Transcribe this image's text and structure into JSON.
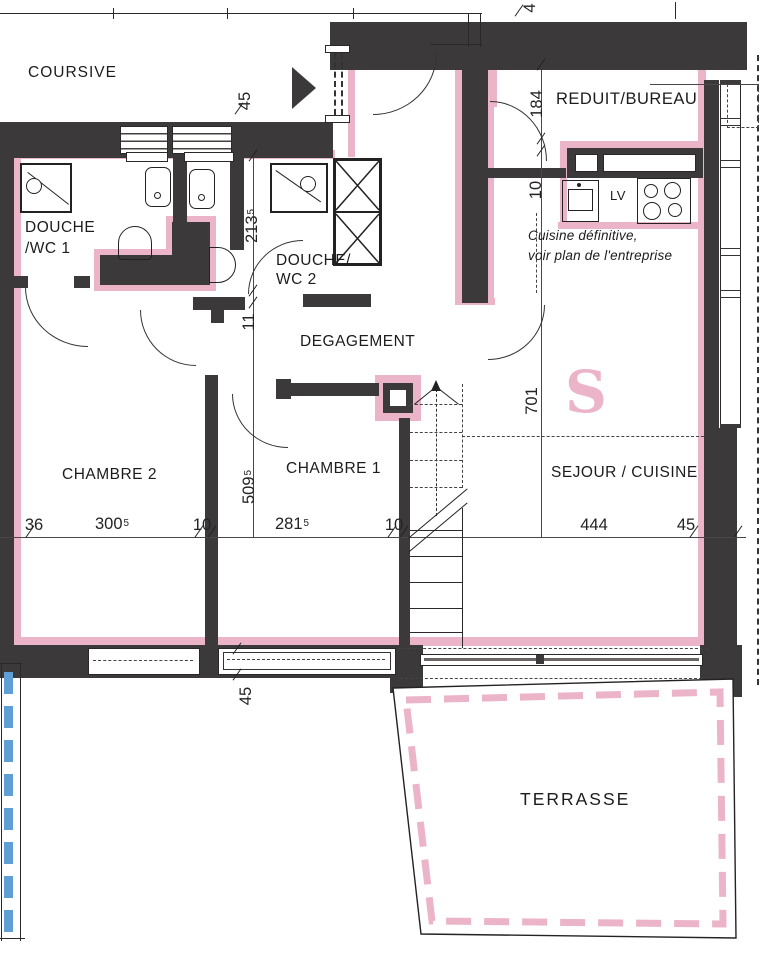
{
  "plan": {
    "rooms": {
      "coursive": "COURSIVE",
      "douche_wc1_l1": "DOUCHE",
      "douche_wc1_l2": "/WC 1",
      "douche_wc2_l1": "DOUCHE/",
      "douche_wc2_l2": "WC 2",
      "degagement": "DEGAGEMENT",
      "reduit_bureau": "REDUIT/BUREAU",
      "sejour_cuisine": "SEJOUR / CUISINE",
      "chambre1": "CHAMBRE 1",
      "chambre2": "CHAMBRE 2",
      "terrasse": "TERRASSE"
    },
    "notes": {
      "kitchen_l1": "Cuisine définitive,",
      "kitchen_l2": "voir plan de l'entreprise",
      "lv": "LV",
      "s": "S"
    },
    "dims": {
      "entry_45": "45",
      "top_4": "4",
      "reduit_184": "184",
      "reduit_10": "10",
      "bath_213": {
        "main": "213",
        "sup": "5"
      },
      "wall_11": "11",
      "rooms_509": {
        "main": "509",
        "sup": "5"
      },
      "sejour_701": "701",
      "row_36": "36",
      "row_300": {
        "main": "300",
        "sup": "5"
      },
      "row_10a": "10",
      "row_281": {
        "main": "281",
        "sup": "5"
      },
      "row_10b": "10",
      "row_444": "444",
      "row_45": "45",
      "bottom_45": "45"
    },
    "colors": {
      "wall": "#3c393a",
      "pink": "#ecb4c8",
      "blue": "#5f9fd6",
      "line": "#2a2829"
    }
  }
}
